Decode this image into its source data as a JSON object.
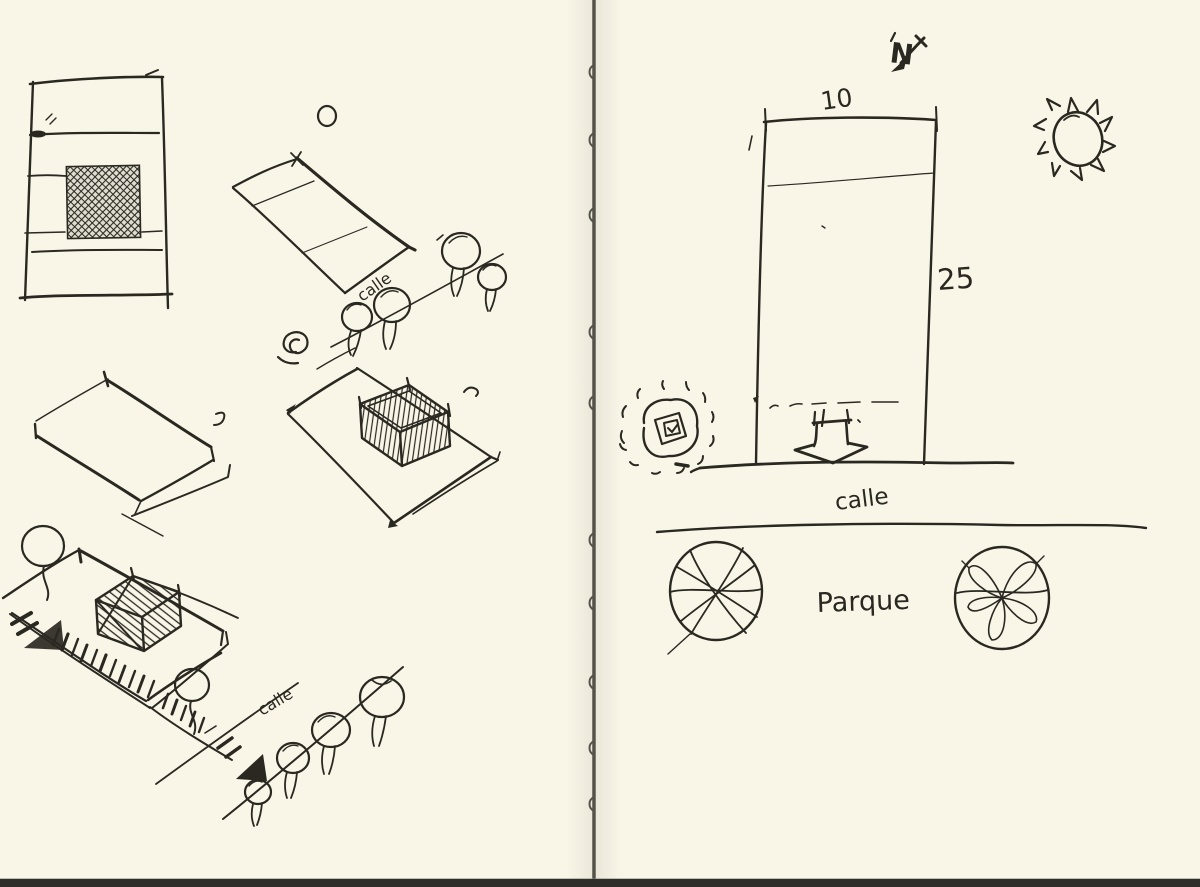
{
  "scan": {
    "type": "sketchbook-spread-scan",
    "paper_color": "#f9f6e8",
    "ink_color": "#2b2822",
    "spine_color": "#55524a",
    "edge_color": "#2f2e2a"
  },
  "left_page": {
    "street_label_top": "calle",
    "street_label_bottom": "calle"
  },
  "right_page": {
    "north_label": "N",
    "width_dimension": "10",
    "height_dimension": "25",
    "street_label": "calle",
    "park_label": "Parque"
  },
  "icons": [
    "north-arrow-icon",
    "sun-icon",
    "spiral-icon",
    "flower-medallion-icon",
    "entrance-arrow-icon",
    "tree-balloon-icon",
    "tree-crossed-icon",
    "tree-leaf-icon"
  ]
}
